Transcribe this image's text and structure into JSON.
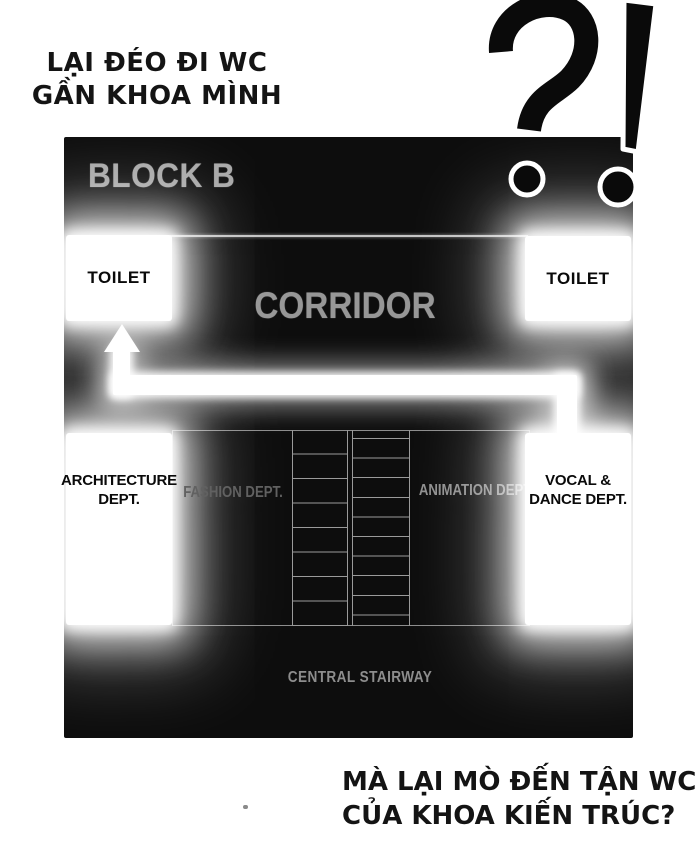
{
  "top_caption": {
    "line1": "LẠI ĐÉO ĐI WC",
    "line2": "GẦN KHOA MÌNH"
  },
  "interjection": "?!",
  "map": {
    "title": "BLOCK B",
    "corridor": "CORRIDOR",
    "toilet_left": "TOILET",
    "toilet_right": "TOILET",
    "dept_architecture_line1": "ARCHITECTURE",
    "dept_architecture_line2": "DEPT.",
    "dept_fashion": "FASHION DEPT.",
    "dept_animation": "ANIMATION DEPT.",
    "dept_vocal_line1": "VOCAL &",
    "dept_vocal_line2": "DANCE DEPT.",
    "central_stairway": "CENTRAL STAIRWAY"
  },
  "bottom_caption": {
    "line1": "MÀ LẠI MÒ ĐẾN TẬN WC",
    "line2": "CỦA KHOA KIẾN TRÚC?"
  },
  "colors": {
    "panel_bg": "#0d0d0d",
    "glow": "#ffffff",
    "label_gray": "#8f8f8f",
    "ink": "#141414"
  }
}
